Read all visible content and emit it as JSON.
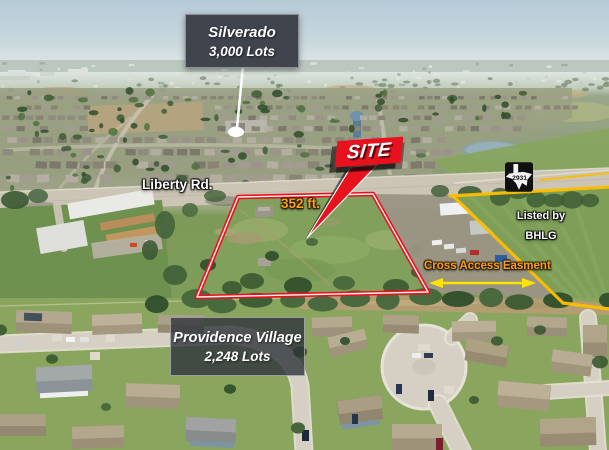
{
  "signs": {
    "silverado": {
      "name": "Silverado",
      "lots": "3,000 Lots"
    },
    "providence": {
      "name": "Providence Village",
      "lots": "2,248 Lots"
    }
  },
  "labels": {
    "site": "SITE",
    "road": "Liberty Rd.",
    "frontage": "352 ft.",
    "easement": "Cross Access Easment",
    "listed_by": "Listed by",
    "broker": "BHLG",
    "road_sign_number": "2931"
  },
  "colors": {
    "site_red": "#e8121e",
    "easement_yellow": "#fcbe00",
    "arrow_yellow": "#ffe400",
    "label_orange": "#f5a01e",
    "sign_bg": "#3f444d"
  }
}
